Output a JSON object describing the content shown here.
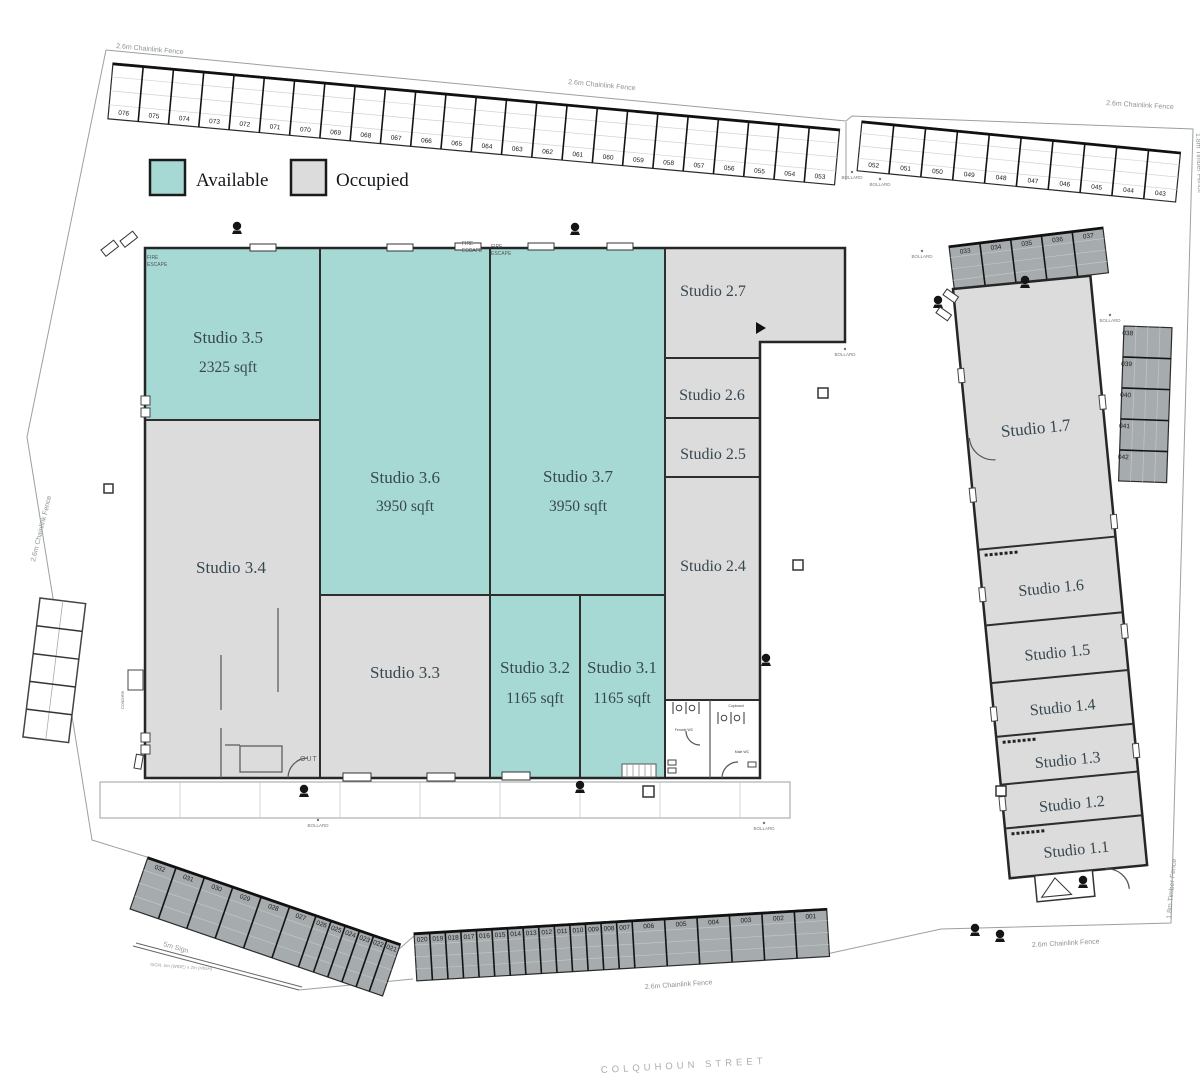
{
  "legend": {
    "available_label": "Available",
    "occupied_label": "Occupied",
    "available_color": "#a6d9d4",
    "occupied_color": "#dcdcdc",
    "parking_color": "#a6abae"
  },
  "studios": {
    "s35": {
      "name": "Studio 3.5",
      "area": "2325 sqft",
      "status": "available"
    },
    "s36": {
      "name": "Studio 3.6",
      "area": "3950 sqft",
      "status": "available"
    },
    "s37": {
      "name": "Studio 3.7",
      "area": "3950 sqft",
      "status": "available"
    },
    "s34": {
      "name": "Studio 3.4",
      "status": "occupied"
    },
    "s33": {
      "name": "Studio 3.3",
      "status": "occupied"
    },
    "s32": {
      "name": "Studio 3.2",
      "area": "1165 sqft",
      "status": "available"
    },
    "s31": {
      "name": "Studio 3.1",
      "area": "1165 sqft",
      "status": "available"
    },
    "s27": {
      "name": "Studio 2.7",
      "status": "occupied"
    },
    "s26": {
      "name": "Studio 2.6",
      "status": "occupied"
    },
    "s25": {
      "name": "Studio 2.5",
      "status": "occupied"
    },
    "s24": {
      "name": "Studio 2.4",
      "status": "occupied"
    },
    "s17": {
      "name": "Studio 1.7",
      "status": "occupied"
    },
    "s16": {
      "name": "Studio 1.6",
      "status": "occupied"
    },
    "s15": {
      "name": "Studio 1.5",
      "status": "occupied"
    },
    "s14": {
      "name": "Studio 1.4",
      "status": "occupied"
    },
    "s13": {
      "name": "Studio 1.3",
      "status": "occupied"
    },
    "s12": {
      "name": "Studio 1.2",
      "status": "occupied"
    },
    "s11": {
      "name": "Studio 1.1",
      "status": "occupied"
    }
  },
  "parking": {
    "top_left": [
      "076",
      "075",
      "074",
      "073",
      "072",
      "071",
      "070",
      "069",
      "068",
      "067",
      "066",
      "065",
      "064",
      "063",
      "062",
      "061",
      "060",
      "059",
      "058",
      "057",
      "056",
      "055",
      "054",
      "053"
    ],
    "top_right": [
      "052",
      "051",
      "050",
      "049",
      "048",
      "047",
      "046",
      "045",
      "044",
      "043"
    ],
    "bottom_left": [
      "032",
      "031",
      "030",
      "029",
      "028",
      "027",
      "026",
      "025",
      "024",
      "023",
      "022",
      "021"
    ],
    "bottom_center": [
      "020",
      "019",
      "018",
      "017",
      "016",
      "015",
      "014",
      "013",
      "012",
      "011",
      "010",
      "009",
      "008",
      "007",
      "006",
      "005",
      "004",
      "003",
      "002",
      "001"
    ],
    "right_top": [
      "033",
      "034",
      "035",
      "036",
      "037"
    ],
    "right_column": [
      "038",
      "039",
      "040",
      "041",
      "042"
    ]
  },
  "labels": {
    "fence_chainlink": "2.6m Chainlink Fence",
    "fence_timber": "1.8m Timber Fence",
    "bollard": "BOLLARD",
    "fire": "FIRE",
    "escape": "ESCAPE",
    "out": "OUT",
    "concrete": "Concrete",
    "street": "COLQUHOUN STREET",
    "sign": "5m Sign",
    "sign_detail": "SIGN: 5m (WIDE) x 2m (HIGH)",
    "female_wc": "Female WC",
    "male_wc": "Male WC",
    "cupboard": "Cupboard"
  }
}
